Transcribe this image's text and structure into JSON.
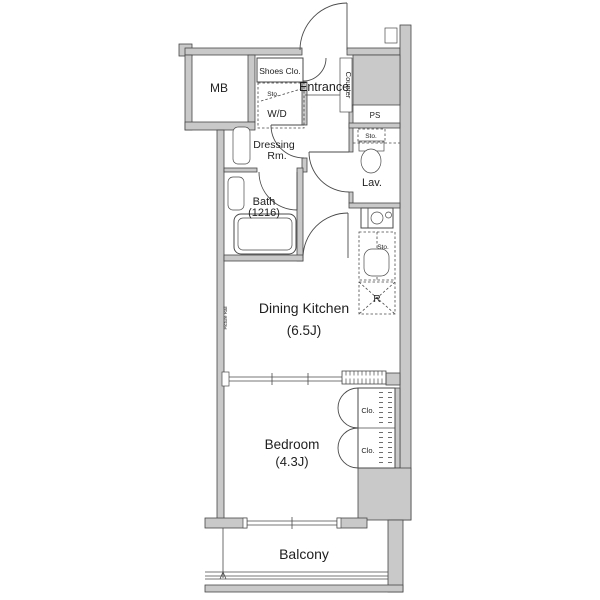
{
  "colors": {
    "background": "#ffffff",
    "wall_fill": "#c9c9c9",
    "wall_stroke": "#474747",
    "line": "#4a4a4a",
    "text": "#1f1f1f"
  },
  "plan": {
    "rooms": {
      "mb": {
        "label": "MB"
      },
      "shoes_closet": {
        "label": "Shoes Clo."
      },
      "entrance": {
        "label": "Entrance"
      },
      "counter": {
        "label": "Counter"
      },
      "washer_dryer": {
        "label": "W/D",
        "storage_label": "Sto."
      },
      "dressing_room": {
        "label_line1": "Dressing",
        "label_line2": "Rm."
      },
      "bath": {
        "label": "Bath",
        "size_label": "(1216)"
      },
      "lavatory": {
        "label": "Lav.",
        "storage_label": "Sto."
      },
      "ps": {
        "label": "PS"
      },
      "kitchen": {
        "storage_label": "Sto.",
        "refrigerator_label": "R"
      },
      "dining_kitchen": {
        "label": "Dining Kitchen",
        "size_label": "(6.5J)"
      },
      "picture_rail": {
        "label": "Picture Rail"
      },
      "bedroom": {
        "label": "Bedroom",
        "size_label": "(4.3J)"
      },
      "closet_upper": {
        "label": "Clo."
      },
      "closet_lower": {
        "label": "Clo."
      },
      "balcony": {
        "label": "Balcony"
      }
    }
  }
}
